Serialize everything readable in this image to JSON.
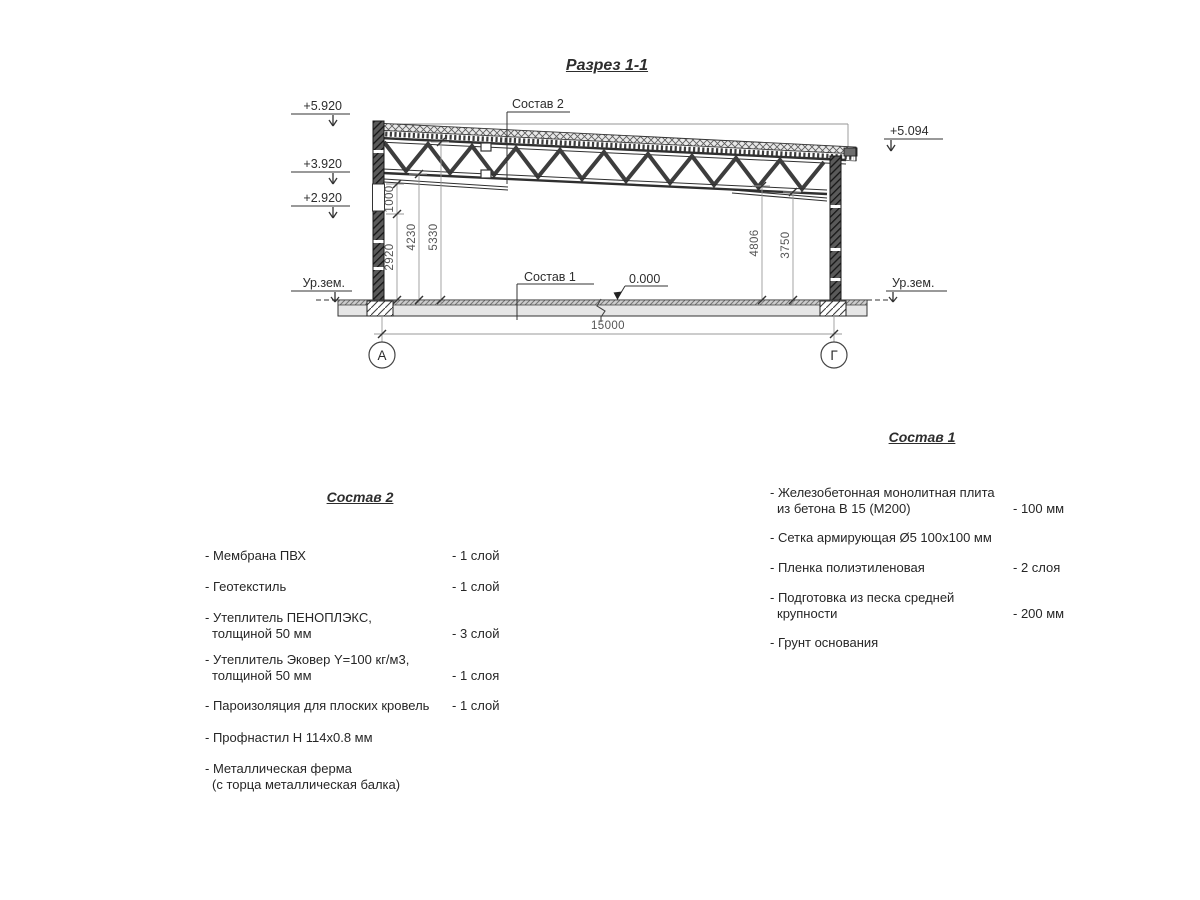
{
  "title": "Разрез 1-1",
  "marks": {
    "e_top_left": "+5.920",
    "e_mid_left": "+3.920",
    "e_low_left": "+2.920",
    "e_top_right": "+5.094",
    "zero": "0.000",
    "ground": "Ур.зем."
  },
  "dims": {
    "d1000": "1000",
    "d2920": "2920",
    "d4230": "4230",
    "d5330": "5330",
    "d4806": "4806",
    "d3750": "3750",
    "span": "15000"
  },
  "axes": {
    "left": "А",
    "right": "Г"
  },
  "callouts": {
    "roof": "Состав 2",
    "floor": "Состав 1"
  },
  "sostav2": {
    "heading": "Состав 2",
    "items": [
      {
        "line1": "- Мембрана ПВХ",
        "qty": "- 1 слой"
      },
      {
        "line1": "- Геотекстиль",
        "qty": "- 1 слой"
      },
      {
        "line1": "- Утеплитель ПЕНОПЛЭКС,",
        "line2": "толщиной 50 мм",
        "qty": "- 3 слой"
      },
      {
        "line1": "- Утеплитель Эковер Y=100 кг/м3,",
        "line2": "толщиной 50 мм",
        "qty": "- 1 слоя"
      },
      {
        "line1": "- Пароизоляция для плоских кровель",
        "qty": "- 1 слой"
      },
      {
        "line1": "- Профнастил Н 114х0.8 мм",
        "qty": ""
      },
      {
        "line1": "- Металлическая ферма",
        "line2": "(с торца металлическая балка)",
        "qty": ""
      }
    ]
  },
  "sostav1": {
    "heading": "Состав 1",
    "items": [
      {
        "line1": "- Железобетонная  монолитная плита",
        "line2": "из бетона В 15 (М200)",
        "qty": "- 100 мм"
      },
      {
        "line1": "- Сетка армирующая Ø5 100х100 мм",
        "qty": ""
      },
      {
        "line1": "- Пленка полиэтиленовая",
        "qty": "-  2 слоя"
      },
      {
        "line1": "- Подготовка из песка средней",
        "line2": "крупности",
        "qty": "- 200 мм"
      },
      {
        "line1": "- Грунт основания",
        "qty": ""
      }
    ]
  }
}
